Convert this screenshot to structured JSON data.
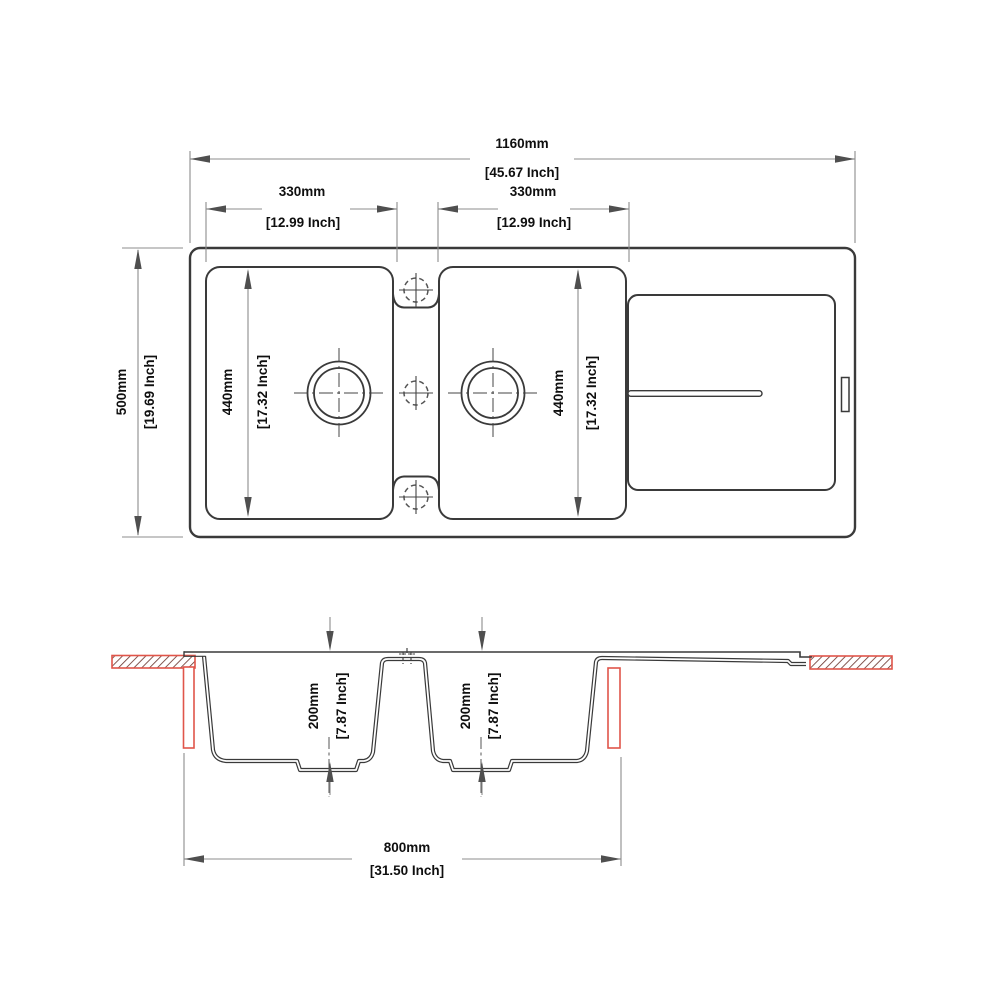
{
  "drawing": {
    "type": "kitchen sink technical drawing, plan and section views",
    "colors": {
      "main_line": "#3a3a3a",
      "dim_line": "#8c8c8c",
      "arrow": "#4f4f4f",
      "text": "#0f0f0f",
      "accent_red": "#e0554a",
      "hatch_line": "#6e3a33"
    },
    "dims": {
      "overall_width": {
        "mm": "1160mm",
        "inch": "[45.67 Inch]"
      },
      "overall_depth": {
        "mm": "500mm",
        "inch": "[19.69 Inch]"
      },
      "bowl1_width": {
        "mm": "330mm",
        "inch": "[12.99 Inch]"
      },
      "bowl2_width": {
        "mm": "330mm",
        "inch": "[12.99 Inch]"
      },
      "bowl1_length": {
        "mm": "440mm",
        "inch": "[17.32 Inch]"
      },
      "bowl2_length": {
        "mm": "440mm",
        "inch": "[17.32 Inch]"
      },
      "bowl1_depth": {
        "mm": "200mm",
        "inch": "[7.87 Inch]"
      },
      "bowl2_depth": {
        "mm": "200mm",
        "inch": "[7.87 Inch]"
      },
      "cutout_width": {
        "mm": "800mm",
        "inch": "[31.50 Inch]"
      }
    }
  }
}
